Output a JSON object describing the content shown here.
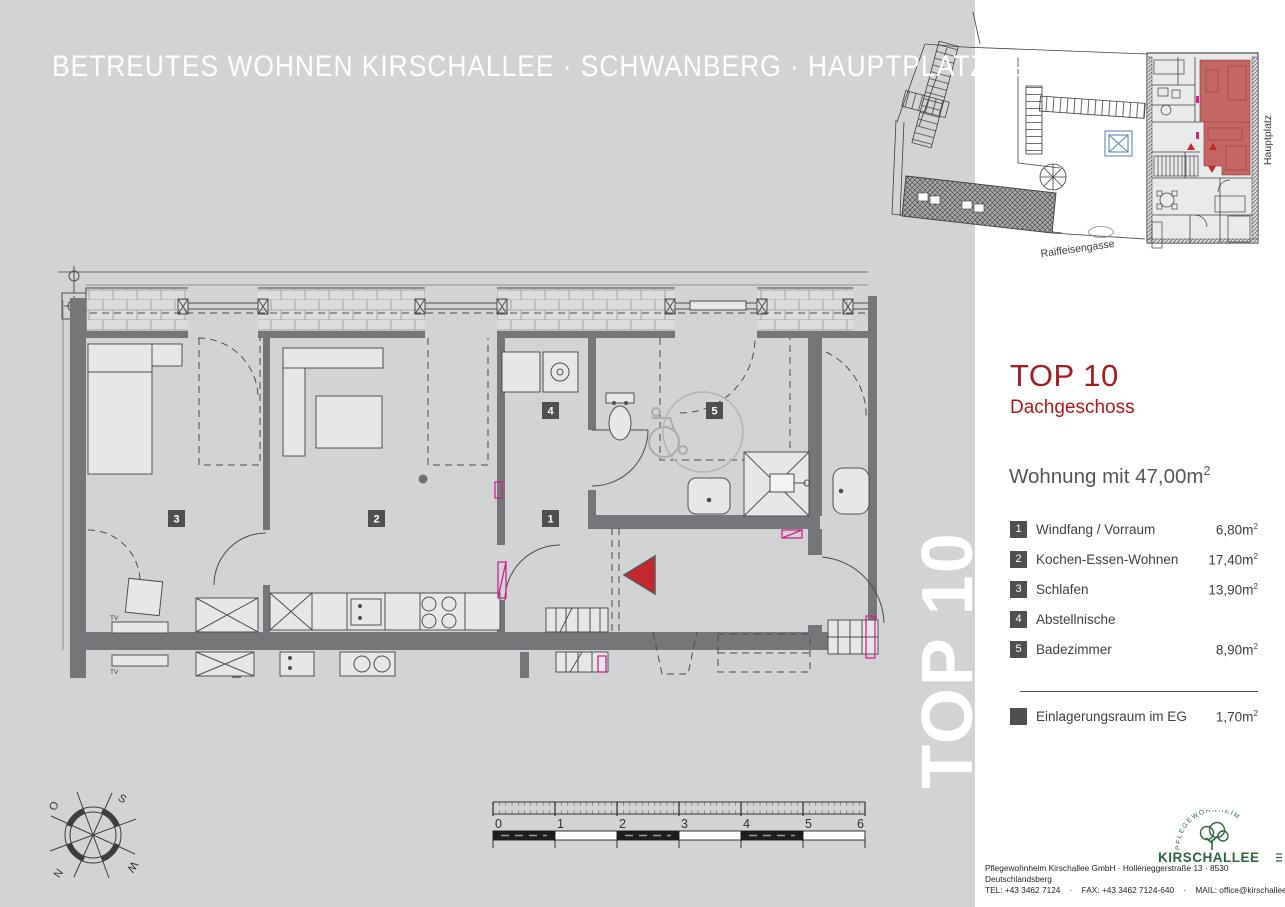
{
  "header": {
    "title": "BETREUTES WOHNEN KIRSCHALLEE · SCHWANBERG · HAUPTPLATZ 19"
  },
  "site_plan": {
    "street_bottom": "Raiffeisengasse",
    "street_right": "Hauptplatz"
  },
  "watermark": "TOP 10",
  "panel": {
    "title": "TOP 10",
    "subtitle": "Dachgeschoss",
    "apartment": {
      "text": "Wohnung mit 47,00m",
      "sup": "2"
    },
    "rooms": [
      {
        "num": "1",
        "label": "Windfang / Vorraum",
        "area": "6,80m",
        "sup": "2"
      },
      {
        "num": "2",
        "label": "Kochen-Essen-Wohnen",
        "area": "17,40m",
        "sup": "2"
      },
      {
        "num": "3",
        "label": "Schlafen",
        "area": "13,90m",
        "sup": "2"
      },
      {
        "num": "4",
        "label": "Abstellnische",
        "area": "",
        "sup": null
      },
      {
        "num": "5",
        "label": "Badezimmer",
        "area": "8,90m",
        "sup": "2"
      }
    ],
    "storage": {
      "label": "Einlagerungsraum im EG",
      "area": "1,70m",
      "sup": "2"
    }
  },
  "plan": {
    "tv_label": "TV",
    "badges": [
      "1",
      "2",
      "3",
      "4",
      "5"
    ]
  },
  "compass": {
    "o": "O",
    "s": "S",
    "n": "N",
    "w": "W"
  },
  "scalebar": {
    "ticks": [
      "0",
      "1",
      "2",
      "3",
      "4",
      "5",
      "6"
    ]
  },
  "footer": {
    "logo_arc": "PFLEGEWOHNHEIM",
    "logo_name": "KIRSCHALLEE",
    "address": "Pflegewohnheim Kirschallee GmbH · Holleneggerstraße 13 · 8530 Deutschlandsberg",
    "contact": "TEL: +43 3462 7124    ·    FAX: +43 3462 7124-640    ·    MAIL: office@kirschallee.at"
  },
  "colors": {
    "accent_red": "#a51c22",
    "unit_fill": "#c05b57",
    "arrow_red": "#c3282b",
    "logo_green": "#2b673c",
    "wall_gray": "#75767a",
    "bg_gray": "#d2d3d5"
  }
}
